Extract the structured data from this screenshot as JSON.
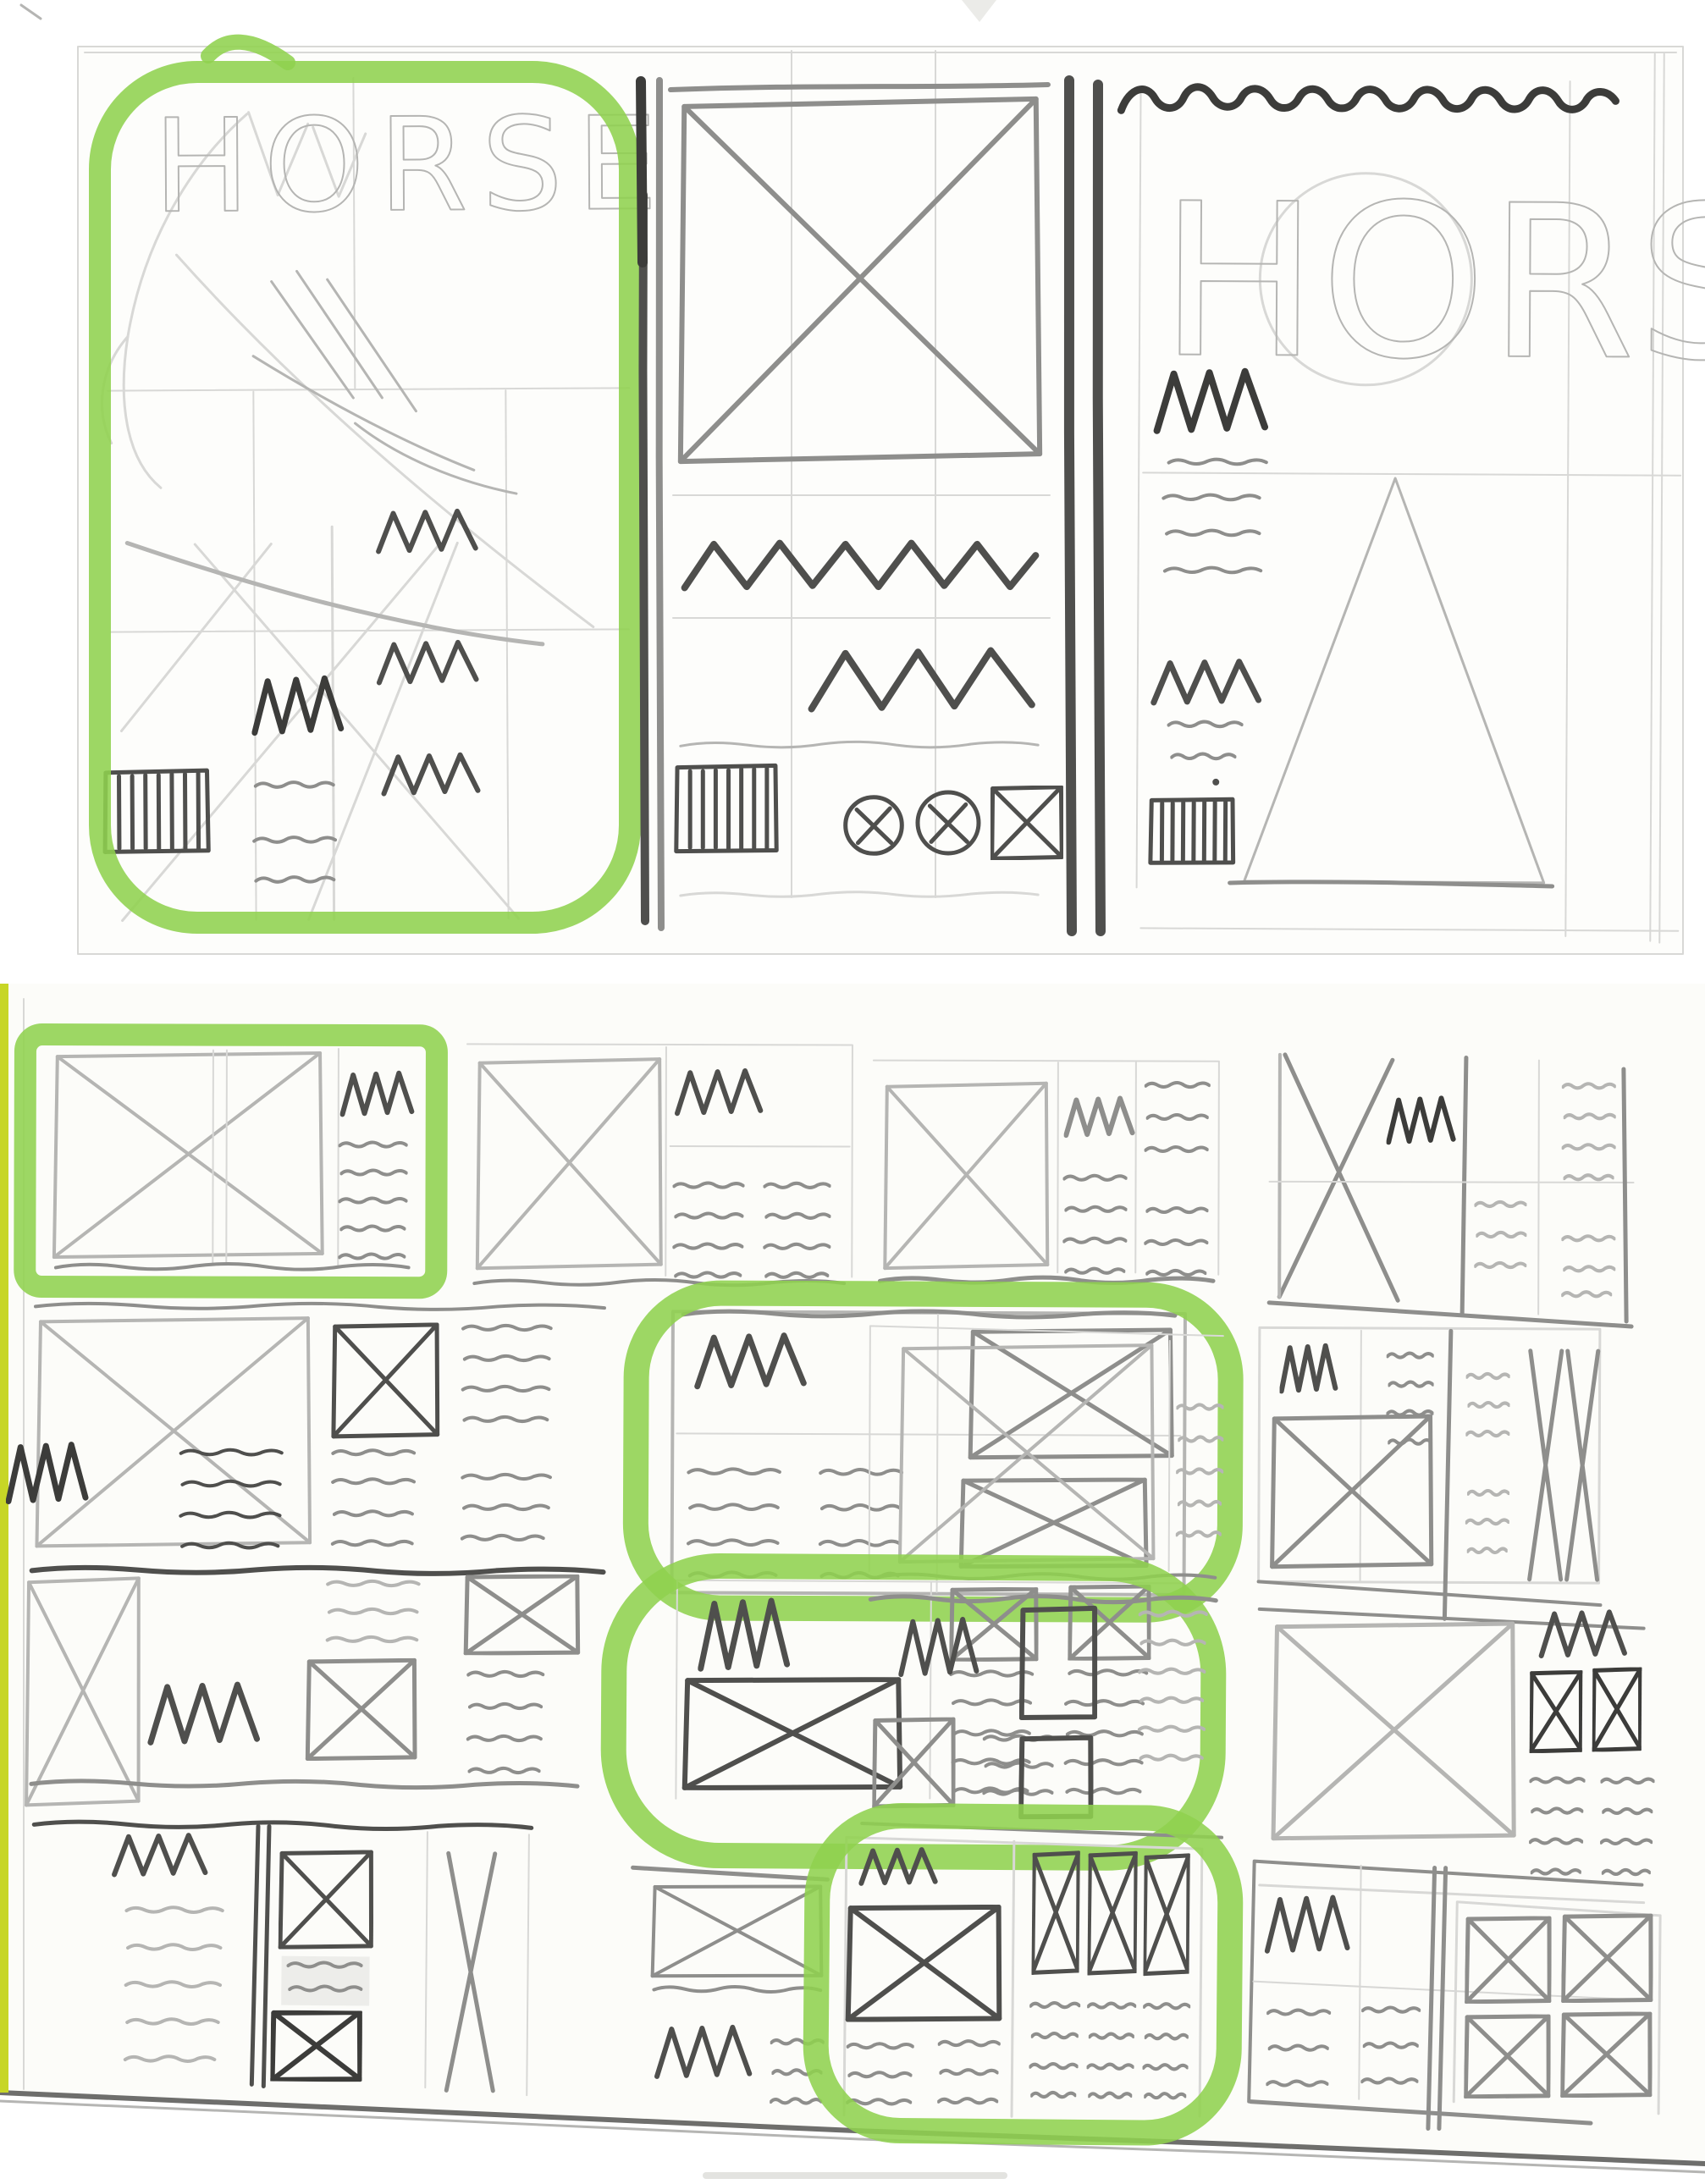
{
  "scan": {
    "description": "Scanned sketchbook pages: pencil magazine-cover concepts titled HORSE and a 4x4 grid of page-layout thumbnails, with green highlighter marking selected sketches",
    "pages": [
      {
        "name": "cover-concept-sketches"
      },
      {
        "name": "layout-thumbnail-grid"
      }
    ]
  },
  "colors": {
    "paper": "#fdfdfb",
    "paper_bottom": "#fcfcf9",
    "pencil_faint": "#d8d8d6",
    "pencil_light": "#b5b5b3",
    "pencil_mid": "#8e8e8c",
    "pencil_dark": "#4f4f4d",
    "pencil_black": "#3c3c3a",
    "highlighter": "#8fd14f",
    "edge_stripe": "#c7d626",
    "torn_edge": "#6e6e6c"
  },
  "cover_sketches": {
    "left": {
      "title": "HORSE",
      "highlighted": true,
      "elements": [
        "horse-head-sketch",
        "headline-squiggles",
        "body-text-lines",
        "barcode"
      ]
    },
    "middle": {
      "title": "",
      "highlighted": false,
      "elements": [
        "hero-image-xbox",
        "headline-squiggle",
        "subhead-squiggle",
        "barcode",
        "photo-chip-icons"
      ]
    },
    "right": {
      "title": "HORSE",
      "highlighted": false,
      "elements": [
        "scalloped-masthead",
        "headline-squiggles",
        "body-text-lines",
        "barcode",
        "mountain-triangle"
      ]
    }
  },
  "thumbnail_grid": {
    "rows": 4,
    "cols": 4,
    "cells": [
      {
        "id": "r1c1",
        "highlighted": true,
        "highlight_shape": "rectangle",
        "composition": "large image xbox left, headline squiggle and text column right"
      },
      {
        "id": "r1c2",
        "highlighted": false,
        "composition": "image xbox left, headline and two text columns right"
      },
      {
        "id": "r1c3",
        "highlighted": false,
        "composition": "image xbox left, headline with text column, text column right"
      },
      {
        "id": "r1c4",
        "highlighted": false,
        "composition": "tall image xbox left, headline squiggle, text columns right"
      },
      {
        "id": "r2c1",
        "highlighted": false,
        "composition": "large xbox top-left, small xbox column, text columns, headline bottom-left"
      },
      {
        "id": "r2c2",
        "highlighted": true,
        "highlight_shape": "round",
        "composition": "headline and two text columns left, two stacked image xboxes right"
      },
      {
        "id": "r2c3",
        "highlighted": false,
        "composition": "large image xbox left, text column right"
      },
      {
        "id": "r2c4",
        "highlighted": false,
        "composition": "headline over image xbox left, text columns middle, tall xboxes right"
      },
      {
        "id": "r3c1",
        "highlighted": false,
        "composition": "tall xbox left, headline, small xboxes and text columns"
      },
      {
        "id": "r3c2",
        "highlighted": true,
        "highlight_shape": "round",
        "composition": "headline top-left, two small xboxes top-right, large xbox bottom-left, two text columns"
      },
      {
        "id": "r3c3",
        "highlighted": false,
        "composition": "headline left, stacked plain boxes, small xbox, text columns"
      },
      {
        "id": "r3c4",
        "highlighted": false,
        "composition": "large image xbox left, headline and two dark xboxes with text right"
      },
      {
        "id": "r4c1",
        "highlighted": false,
        "composition": "headline and text column left, xbox-shaded-xbox column, tall xbox right"
      },
      {
        "id": "r4c2",
        "highlighted": false,
        "composition": "image xbox top, headline and short text columns"
      },
      {
        "id": "r4c3",
        "highlighted": true,
        "highlight_shape": "round",
        "composition": "headline over large xbox with text left, three tall xboxes over three text columns right"
      },
      {
        "id": "r4c4",
        "highlighted": false,
        "composition": "headline and two text columns left, 2x2 grid of image xboxes right"
      }
    ]
  }
}
